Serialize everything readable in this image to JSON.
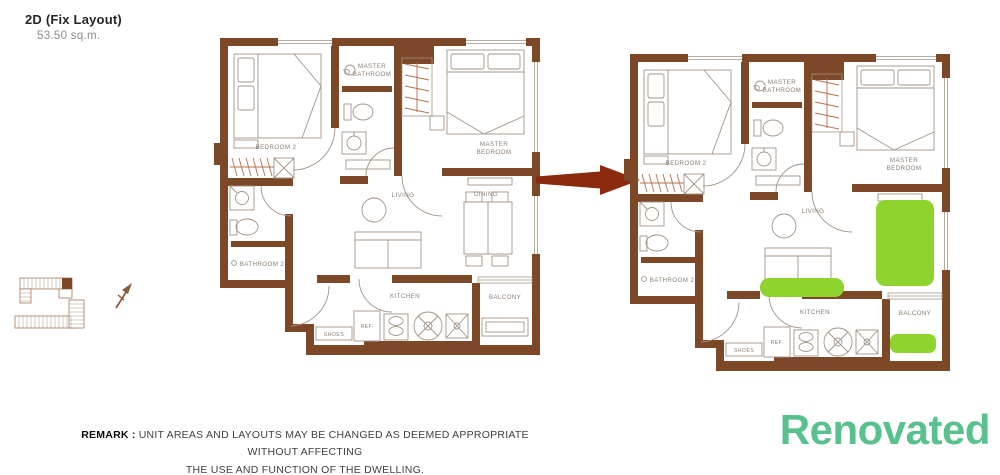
{
  "header": {
    "title": "2D (Fix Layout)",
    "area": "53.50 sq.m."
  },
  "room_labels": {
    "bedroom2": "BEDROOM 2",
    "master_bathroom": [
      "MASTER",
      "BATHROOM"
    ],
    "master_bedroom": [
      "MASTER",
      "BEDROOM"
    ],
    "bathroom2": "BATHROOM 2",
    "living": "LIVING",
    "dining": "DINING",
    "kitchen": "KITCHEN",
    "balcony": "BALCONY",
    "shoes": "SHOES",
    "ref": "REF."
  },
  "remark": {
    "label": "REMARK :",
    "line1": "UNIT AREAS AND LAYOUTS MAY BE CHANGED AS DEEMED APPROPRIATE WITHOUT AFFECTING",
    "line2": "THE USE AND FUNCTION OF THE DWELLING."
  },
  "renovated_label": "Renovated",
  "colors": {
    "wall": "#7d4827",
    "furniture_line": "#a39486",
    "hanger_line": "#b3714d",
    "label_text": "#8b7e73",
    "arrow": "#8a2b10",
    "highlight_green": "#8fd42e",
    "renovated_green": "#58c18e",
    "keyplan_line": "#a2795d"
  }
}
